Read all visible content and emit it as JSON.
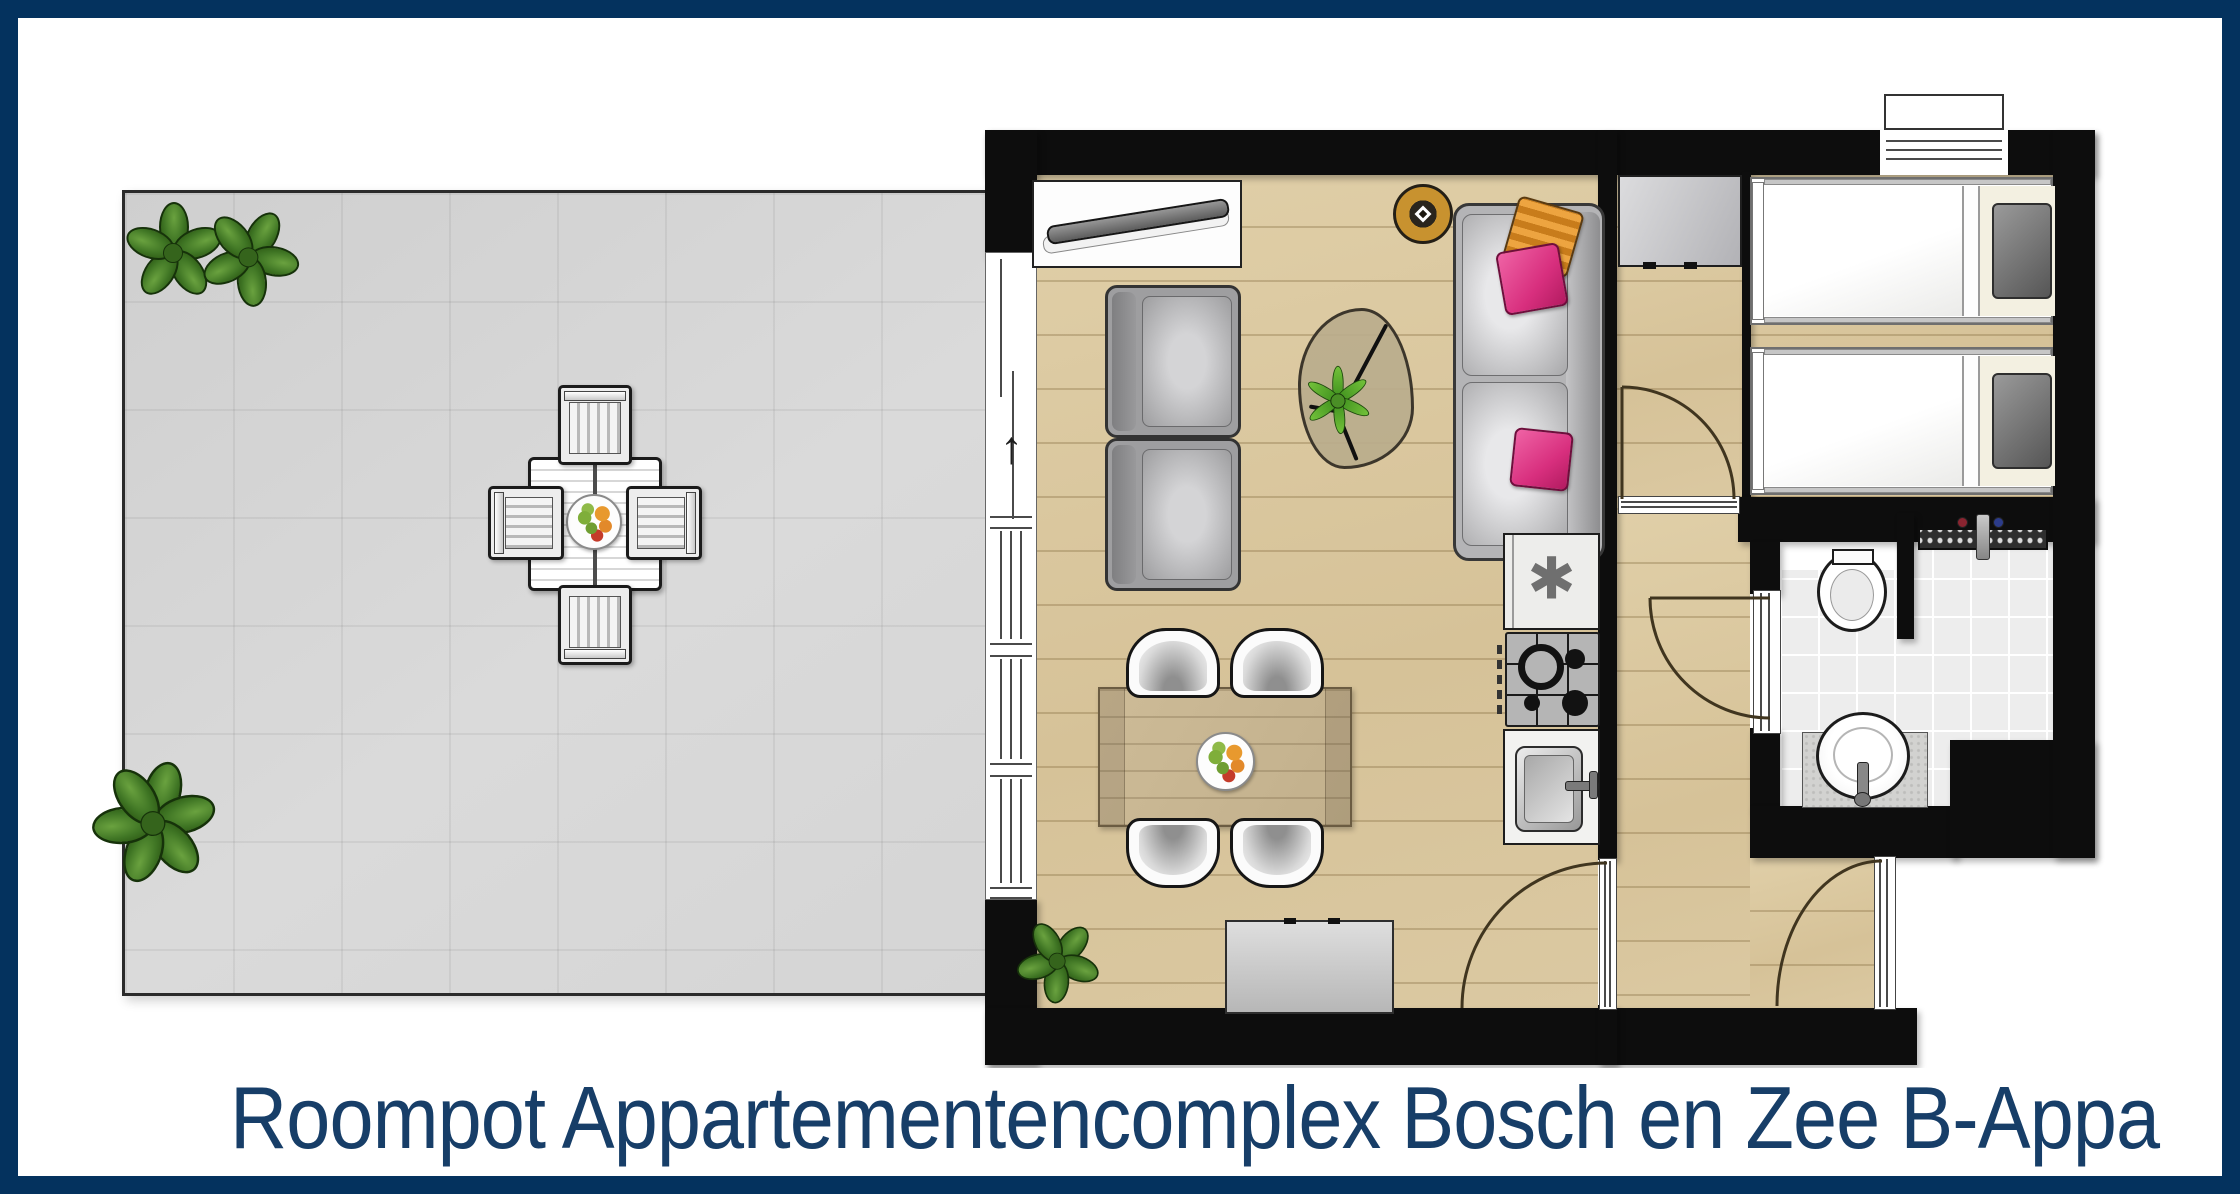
{
  "title": {
    "text": "Roompot Appartementencomplex Bosch en Zee B-Appa"
  },
  "glyphs": {
    "north_arrow": "↑",
    "freezer_star": "✱"
  },
  "colors": {
    "frame_navy": "#04325e",
    "title_navy": "#173e68",
    "wall_black": "#0d0d0d",
    "wood_floor": "#dbc9a2",
    "terrace_gray": "#d6d6d6",
    "bath_tile": "#ededed",
    "pillow_pink": "#d82f7e",
    "pillow_orange": "#e89b33",
    "plant_green": "#3f7524",
    "lamp_gold": "#c8922f"
  },
  "floorplan": {
    "type": "apartment-floor-plan",
    "rooms": [
      {
        "name": "terrace",
        "furniture": [
          "outdoor dining table",
          "4 slatted chairs",
          "fruit bowl",
          "2 plants top-left",
          "1 plant bottom-left"
        ]
      },
      {
        "name": "living-room",
        "furniture": [
          "wall tv on shelf",
          "ceiling lamp",
          "2-seat sofa with pink and orange pillows",
          "2 armchairs",
          "organic coffee table with plant",
          "dining table with fruit bowl",
          "4 dining chairs",
          "sideboard",
          "floor plant",
          "north arrow at sliding door"
        ]
      },
      {
        "name": "kitchenette",
        "furniture": [
          "fridge with freezer star",
          "4-burner gas hob",
          "sink with faucet"
        ]
      },
      {
        "name": "bedroom",
        "furniture": [
          "wardrobe",
          "single bed 1",
          "single bed 2",
          "window with outer sill"
        ]
      },
      {
        "name": "bathroom",
        "furniture": [
          "toilet",
          "shower drain with mixer tap",
          "washbasin on counter"
        ]
      },
      {
        "name": "hallway",
        "furniture": [
          "entrance door",
          "bedroom door",
          "bathroom door",
          "living room door"
        ]
      }
    ]
  }
}
